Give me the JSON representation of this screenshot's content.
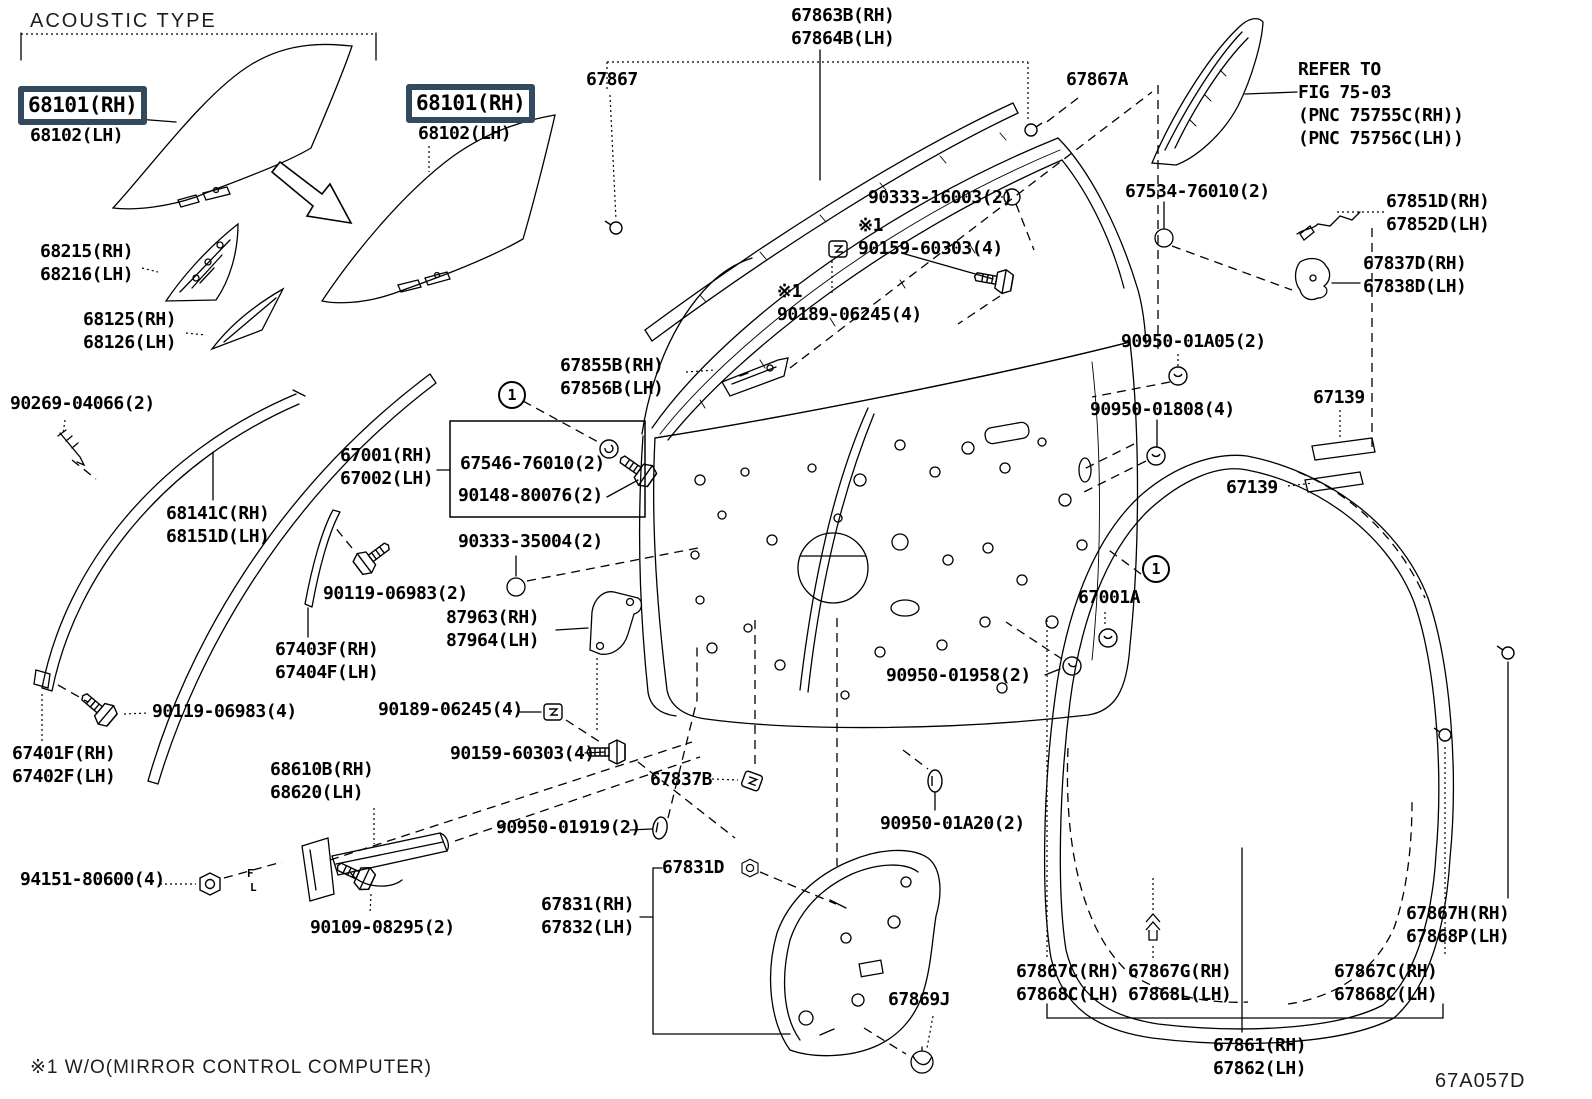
{
  "page": {
    "title": "ACOUSTIC TYPE",
    "footnote": "※1  W/O(MIRROR CONTROL COMPUTER)",
    "diagram_code": "67A057D",
    "highlight_color": "#334a5e",
    "line_color": "#000000",
    "background_color": "#ffffff"
  },
  "icons": {
    "screw-icon": "hex-head bolt with threaded shaft",
    "clip-icon": "square retainer clip",
    "grommet-icon": "round grommet",
    "plug-icon": "oval hole plug",
    "nut-icon": "hex nut",
    "ring-clip-icon": "open ring snap",
    "pin-clip-icon": "push pin clip",
    "fir-tree-clip-icon": "fir tree clip",
    "arrow-icon": "block arrow pointing lower-right"
  },
  "callouts": [
    {
      "n": "1",
      "x": 498,
      "y": 381
    },
    {
      "n": "1",
      "x": 1142,
      "y": 555
    }
  ],
  "labels": [
    {
      "id": "68101-rh-box-1",
      "x": 18,
      "y": 86,
      "boxed": true,
      "lines": [
        "68101(RH)"
      ]
    },
    {
      "id": "68102-lh-1",
      "x": 30,
      "y": 124,
      "lines": [
        "68102(LH)"
      ]
    },
    {
      "id": "68101-rh-box-2",
      "x": 406,
      "y": 84,
      "boxed": true,
      "lines": [
        "68101(RH)"
      ]
    },
    {
      "id": "68102-lh-2",
      "x": 418,
      "y": 122,
      "lines": [
        "68102(LH)"
      ]
    },
    {
      "id": "68215",
      "x": 40,
      "y": 240,
      "lines": [
        "68215(RH)",
        "68216(LH)"
      ]
    },
    {
      "id": "68125",
      "x": 83,
      "y": 308,
      "lines": [
        "68125(RH)",
        "68126(LH)"
      ]
    },
    {
      "id": "67867",
      "x": 586,
      "y": 68,
      "lines": [
        "67867"
      ]
    },
    {
      "id": "67863b",
      "x": 791,
      "y": 4,
      "lines": [
        "67863B(RH)",
        "67864B(LH)"
      ]
    },
    {
      "id": "67867a",
      "x": 1066,
      "y": 68,
      "lines": [
        "67867A"
      ]
    },
    {
      "id": "refer-note",
      "x": 1298,
      "y": 58,
      "lines": [
        "REFER TO",
        "FIG 75-03",
        "(PNC 75755C(RH))",
        "(PNC 75756C(LH))"
      ]
    },
    {
      "id": "90333-16003",
      "x": 868,
      "y": 186,
      "lines": [
        "90333-16003(2)"
      ]
    },
    {
      "id": "90159-60303-top",
      "x": 858,
      "y": 214,
      "lines": [
        "※1",
        "90159-60303(4)"
      ]
    },
    {
      "id": "90189-06245-top",
      "x": 777,
      "y": 280,
      "lines": [
        "※1",
        "90189-06245(4)"
      ]
    },
    {
      "id": "67534-76010",
      "x": 1125,
      "y": 180,
      "lines": [
        "67534-76010(2)"
      ]
    },
    {
      "id": "67851d",
      "x": 1386,
      "y": 190,
      "lines": [
        "67851D(RH)",
        "67852D(LH)"
      ]
    },
    {
      "id": "67837d",
      "x": 1363,
      "y": 252,
      "lines": [
        "67837D(RH)",
        "67838D(LH)"
      ]
    },
    {
      "id": "90950-01a05",
      "x": 1121,
      "y": 330,
      "lines": [
        "90950-01A05(2)"
      ]
    },
    {
      "id": "90950-01808",
      "x": 1090,
      "y": 398,
      "lines": [
        "90950-01808(4)"
      ]
    },
    {
      "id": "67139-a",
      "x": 1313,
      "y": 386,
      "lines": [
        "67139"
      ]
    },
    {
      "id": "67139-b",
      "x": 1226,
      "y": 476,
      "lines": [
        "67139"
      ]
    },
    {
      "id": "67001a",
      "x": 1078,
      "y": 586,
      "lines": [
        "67001A"
      ]
    },
    {
      "id": "90269-04066",
      "x": 10,
      "y": 392,
      "lines": [
        "90269-04066(2)"
      ]
    },
    {
      "id": "68141c",
      "x": 166,
      "y": 502,
      "lines": [
        "68141C(RH)",
        "68151D(LH)"
      ]
    },
    {
      "id": "67001",
      "x": 340,
      "y": 444,
      "lines": [
        "67001(RH)",
        "67002(LH)"
      ]
    },
    {
      "id": "67546-76010",
      "x": 460,
      "y": 452,
      "lines": [
        "67546-76010(2)"
      ]
    },
    {
      "id": "90148-80076",
      "x": 458,
      "y": 484,
      "lines": [
        "90148-80076(2)"
      ]
    },
    {
      "id": "90333-35004",
      "x": 458,
      "y": 530,
      "lines": [
        "90333-35004(2)"
      ]
    },
    {
      "id": "90119-06983-2",
      "x": 323,
      "y": 582,
      "lines": [
        "90119-06983(2)"
      ]
    },
    {
      "id": "87963",
      "x": 446,
      "y": 606,
      "lines": [
        "87963(RH)",
        "87964(LH)"
      ]
    },
    {
      "id": "67403f",
      "x": 275,
      "y": 638,
      "lines": [
        "67403F(RH)",
        "67404F(LH)"
      ]
    },
    {
      "id": "67401f",
      "x": 12,
      "y": 742,
      "lines": [
        "67401F(RH)",
        "67402F(LH)"
      ]
    },
    {
      "id": "90119-06983-4",
      "x": 152,
      "y": 700,
      "lines": [
        "90119-06983(4)"
      ]
    },
    {
      "id": "68610b",
      "x": 270,
      "y": 758,
      "lines": [
        "68610B(RH)",
        "68620(LH)"
      ]
    },
    {
      "id": "94151-80600",
      "x": 20,
      "y": 868,
      "lines": [
        "94151-80600(4)"
      ]
    },
    {
      "id": "90109-08295",
      "x": 310,
      "y": 916,
      "lines": [
        "90109-08295(2)"
      ]
    },
    {
      "id": "check-f",
      "x": 247,
      "y": 868,
      "size": "sm",
      "lines": [
        "F"
      ]
    },
    {
      "id": "check-l",
      "x": 250,
      "y": 882,
      "size": "sm",
      "lines": [
        "L"
      ]
    },
    {
      "id": "67855b",
      "x": 560,
      "y": 354,
      "lines": [
        "67855B(RH)",
        "67856B(LH)"
      ]
    },
    {
      "id": "90189-06245-bot",
      "x": 378,
      "y": 698,
      "lines": [
        "90189-06245(4)"
      ]
    },
    {
      "id": "90159-60303-bot",
      "x": 450,
      "y": 742,
      "lines": [
        "90159-60303(4)"
      ]
    },
    {
      "id": "67837b",
      "x": 650,
      "y": 768,
      "lines": [
        "67837B"
      ]
    },
    {
      "id": "90950-01919",
      "x": 496,
      "y": 816,
      "lines": [
        "90950-01919(2)"
      ]
    },
    {
      "id": "67831d",
      "x": 662,
      "y": 856,
      "lines": [
        "67831D"
      ]
    },
    {
      "id": "67831",
      "x": 541,
      "y": 893,
      "lines": [
        "67831(RH)",
        "67832(LH)"
      ]
    },
    {
      "id": "67869j",
      "x": 888,
      "y": 988,
      "lines": [
        "67869J"
      ]
    },
    {
      "id": "90950-01958",
      "x": 886,
      "y": 664,
      "lines": [
        "90950-01958(2)"
      ]
    },
    {
      "id": "90950-01a20",
      "x": 880,
      "y": 812,
      "lines": [
        "90950-01A20(2)"
      ]
    },
    {
      "id": "67867c-left",
      "x": 1016,
      "y": 960,
      "lines": [
        "67867C(RH)",
        "67868C(LH)"
      ]
    },
    {
      "id": "67867g",
      "x": 1128,
      "y": 960,
      "lines": [
        "67867G(RH)",
        "67868L(LH)"
      ]
    },
    {
      "id": "67867c-right",
      "x": 1334,
      "y": 960,
      "lines": [
        "67867C(RH)",
        "67868C(LH)"
      ]
    },
    {
      "id": "67867h",
      "x": 1406,
      "y": 902,
      "lines": [
        "67867H(RH)",
        "67868P(LH)"
      ]
    },
    {
      "id": "67861",
      "x": 1213,
      "y": 1034,
      "lines": [
        "67861(RH)",
        "67862(LH)"
      ]
    }
  ]
}
